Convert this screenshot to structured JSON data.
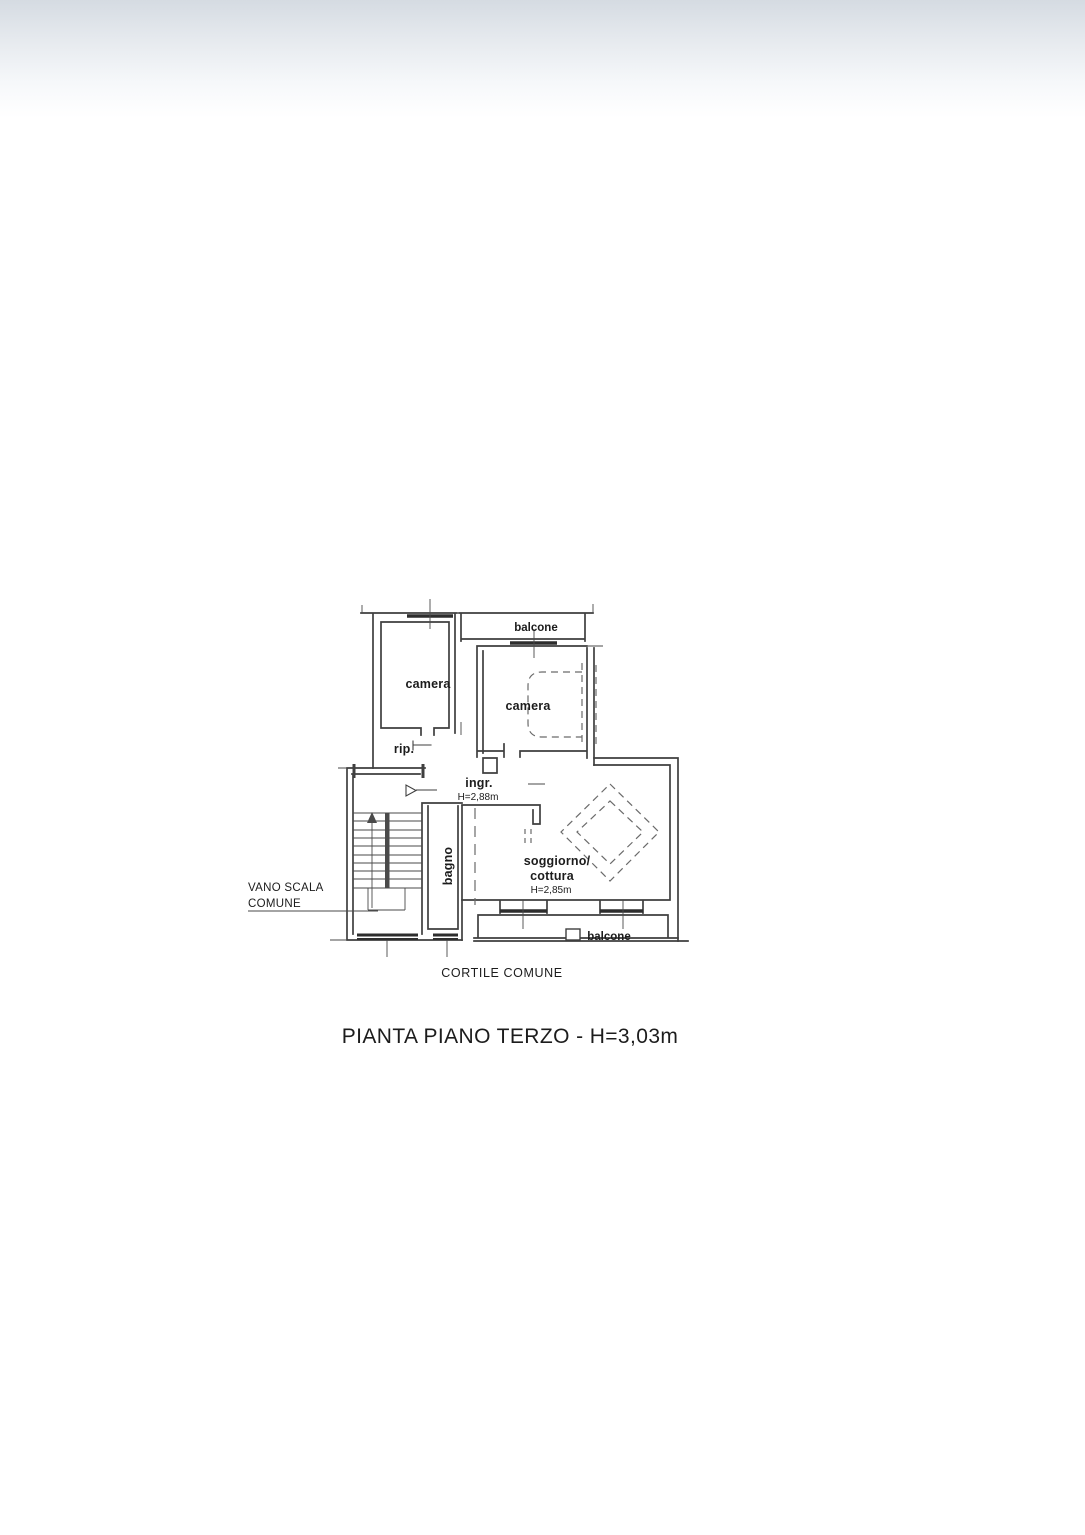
{
  "colors": {
    "wall_line": "#3f3f3f",
    "dashed_line": "#6a6a6a",
    "text": "#1c1c1c",
    "gradient_top": "#d5dbe2",
    "page_background": "#ffffff"
  },
  "floor_plan": {
    "rooms": {
      "balcone_top": "balcone",
      "camera_1": "camera",
      "camera_2": "camera",
      "rip": "rip.",
      "ingr": "ingr.",
      "ingr_height": "H=2,88m",
      "bagno": "bagno",
      "soggiorno_line_1": "soggiorno/",
      "soggiorno_line_2": "cottura",
      "soggiorno_height": "H=2,85m",
      "balcone_bottom": "balcone"
    },
    "annotations": {
      "vano_scala_line_1": "VANO SCALA",
      "vano_scala_line_2": "COMUNE",
      "cortile": "CORTILE COMUNE"
    },
    "title": "PIANTA PIANO TERZO - H=3,03m"
  }
}
